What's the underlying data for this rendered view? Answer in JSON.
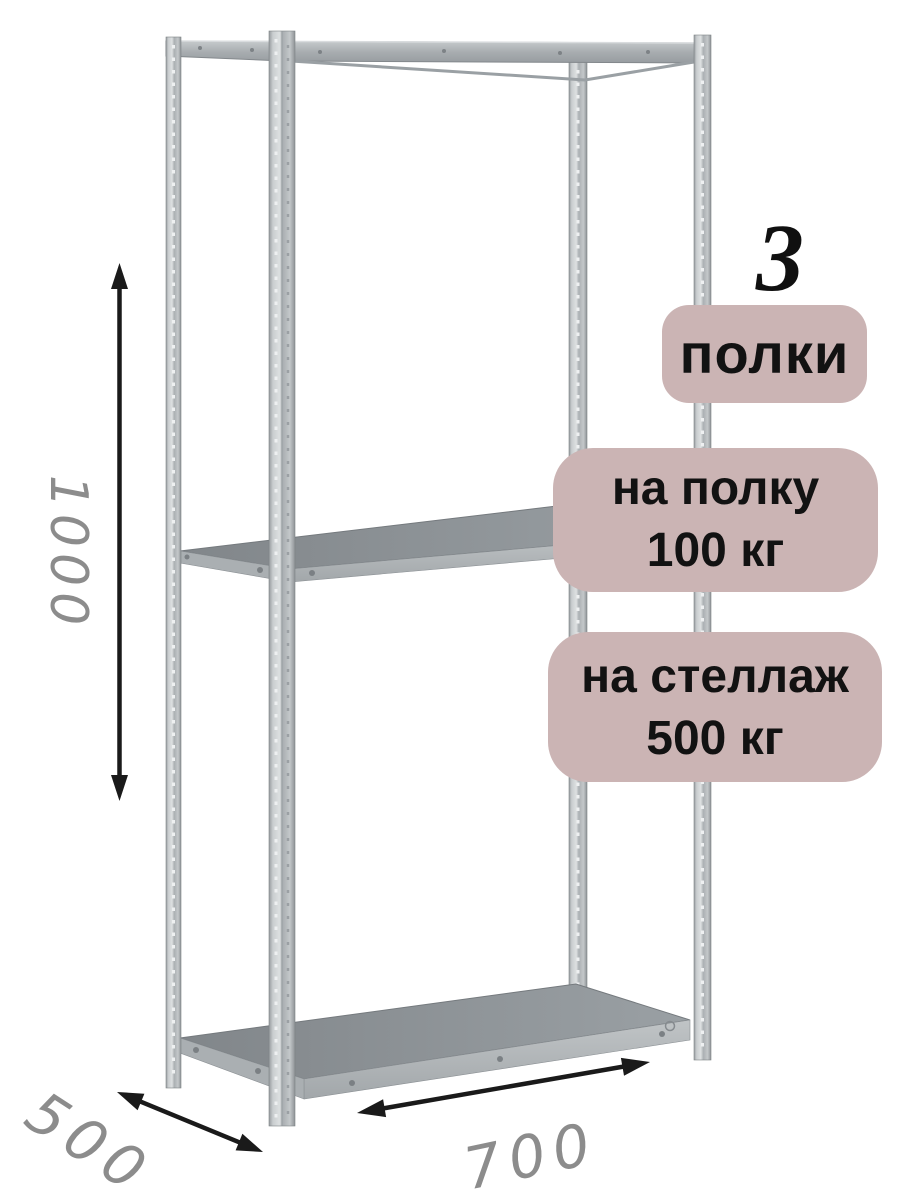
{
  "product": {
    "shelf_count": "3",
    "badge_shelves": "полки",
    "badge_per_shelf": {
      "line1": "на полку",
      "line2": "100 кг"
    },
    "badge_per_rack": {
      "line1": "на стеллаж",
      "line2": "500 кг"
    },
    "dimensions": {
      "height": "1000",
      "depth": "500",
      "width": "700"
    }
  },
  "colors": {
    "badge_background": "#cbb4b4",
    "badge_text": "#121212",
    "count_text": "#101010",
    "dimension_text": "#8c8c8c",
    "arrow": "#1a1a1a",
    "metal_light": "#d8dbdd",
    "metal_mid": "#a9aeb1",
    "shelf_surface": "#8e9397"
  }
}
